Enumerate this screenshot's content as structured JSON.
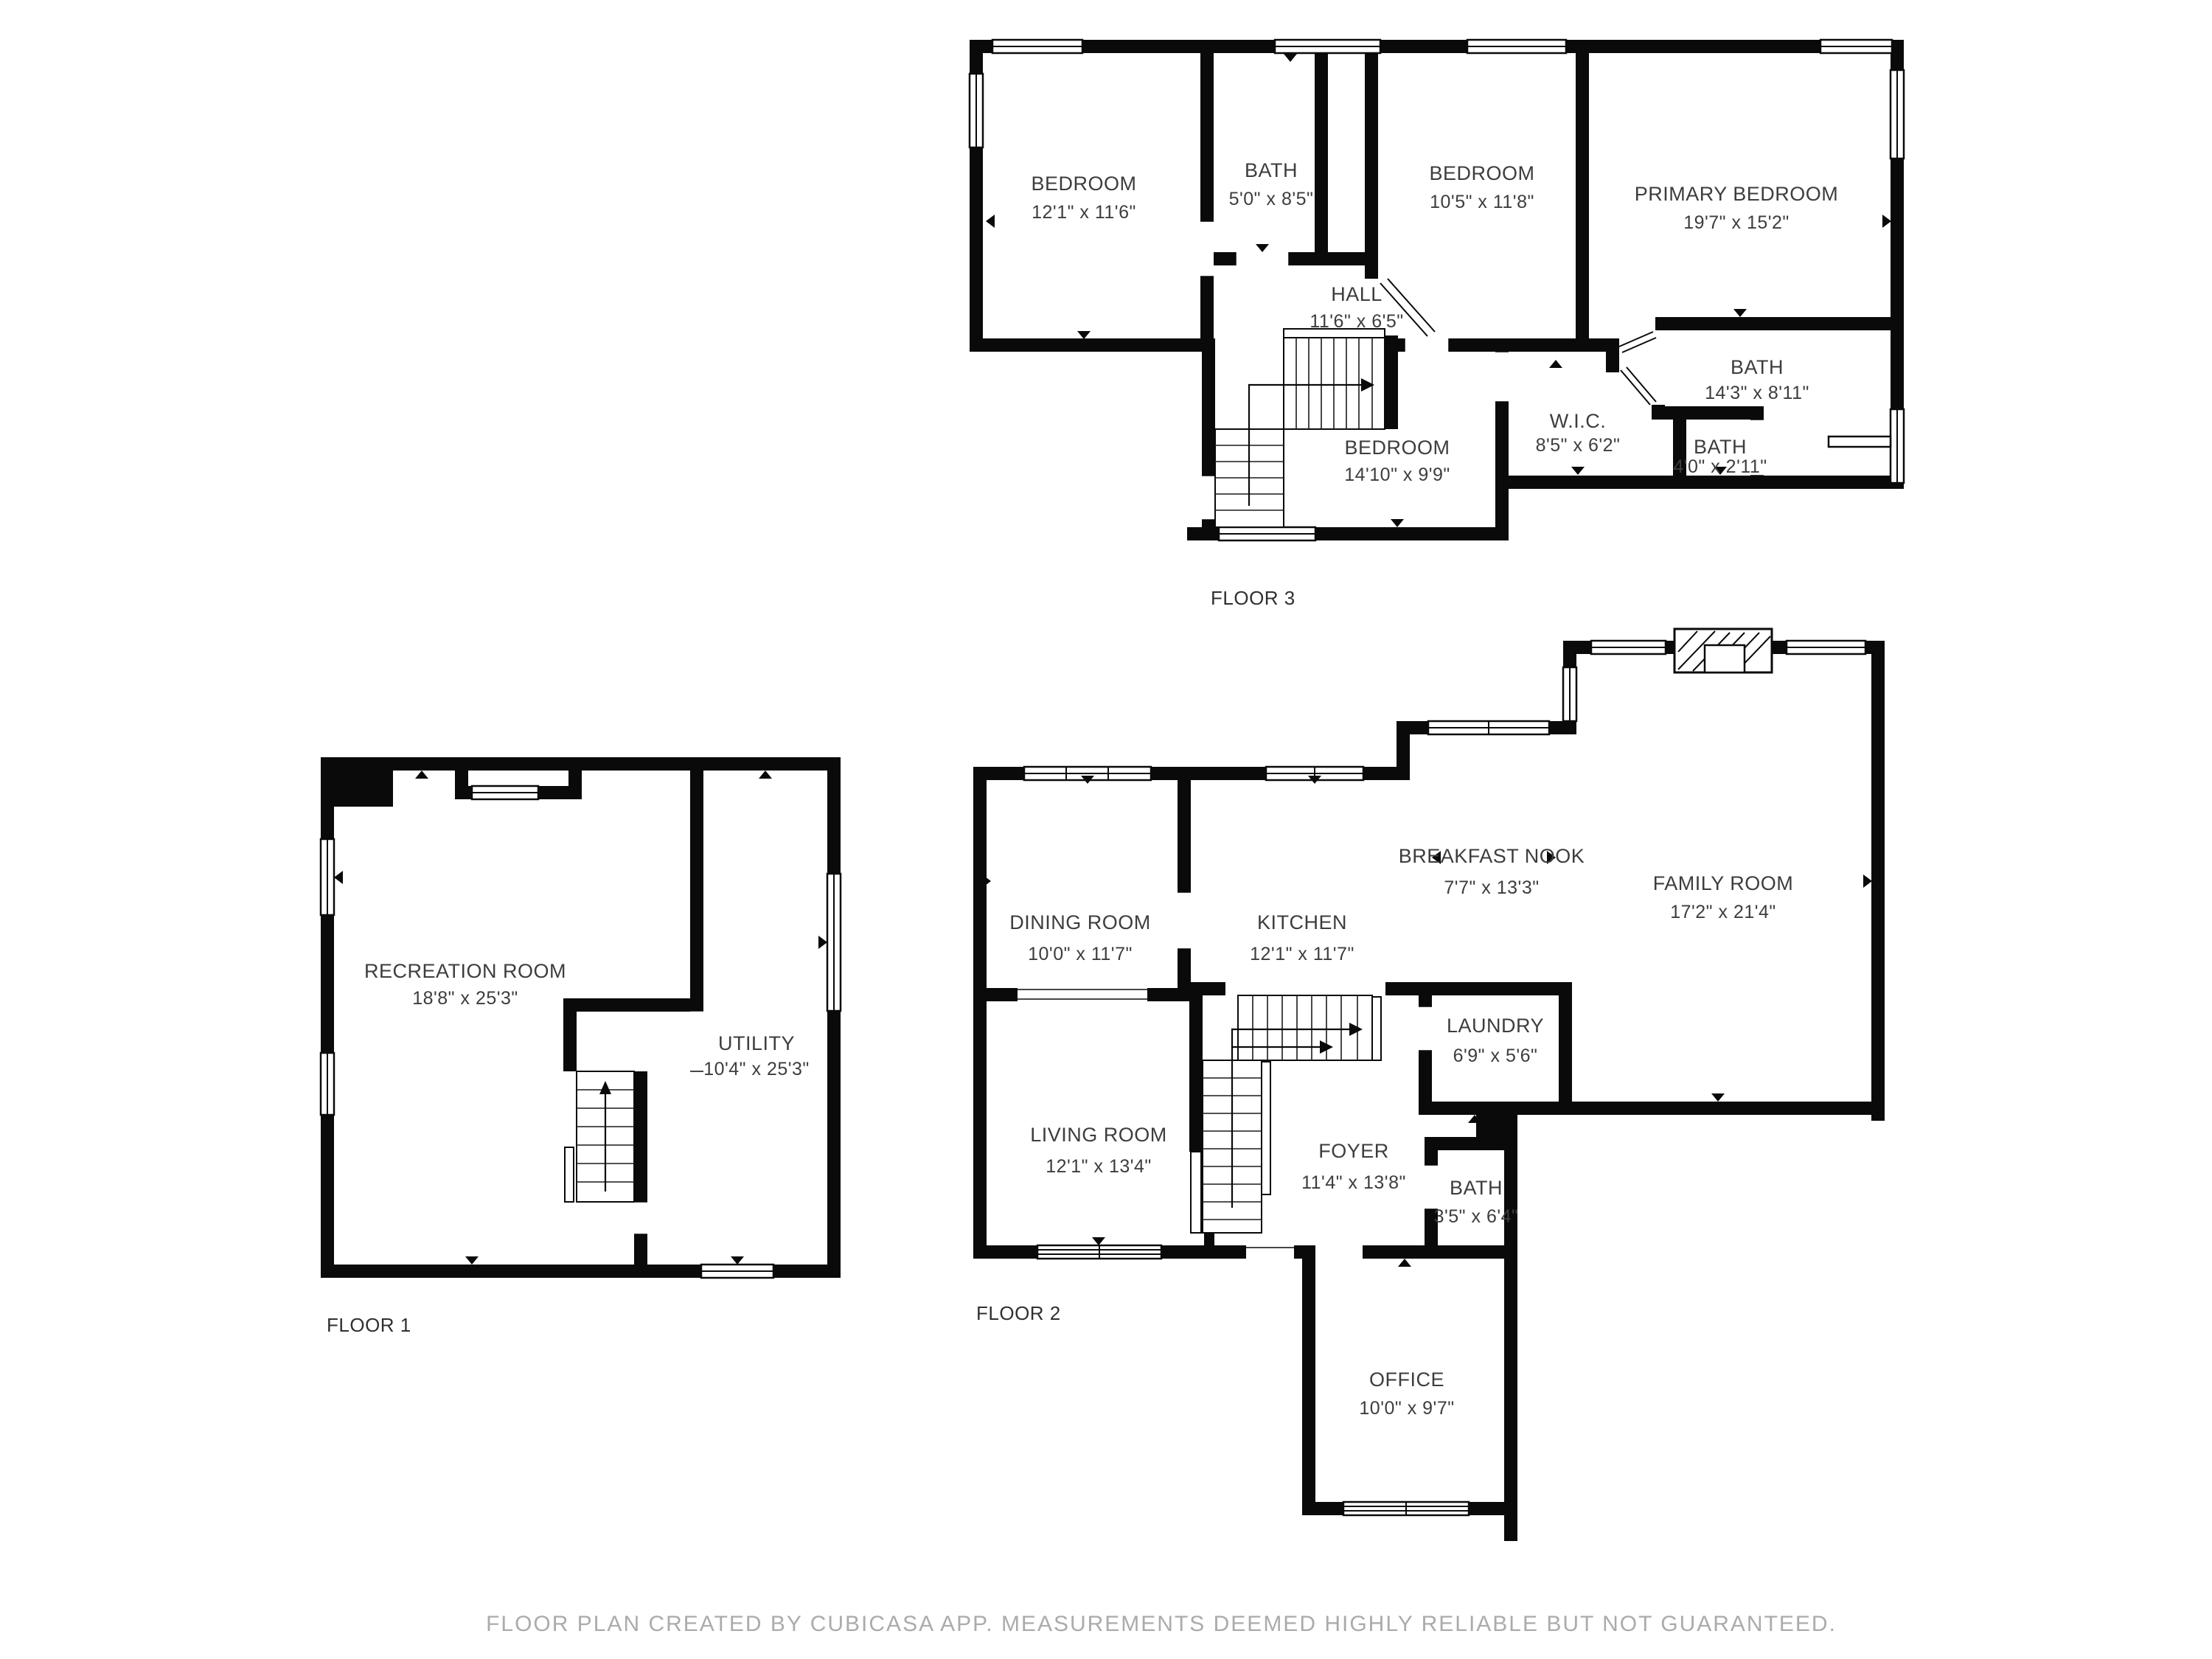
{
  "footer": {
    "disclaimer": "FLOOR PLAN CREATED BY CUBICASA APP. MEASUREMENTS DEEMED HIGHLY RELIABLE BUT NOT GUARANTEED."
  },
  "floors": {
    "floor3": {
      "label": "FLOOR 3",
      "rooms": {
        "bedroom_a": {
          "name": "BEDROOM",
          "dims": "12'1\" x 11'6\""
        },
        "bath_a": {
          "name": "BATH",
          "dims": "5'0\" x 8'5\""
        },
        "bedroom_b": {
          "name": "BEDROOM",
          "dims": "10'5\" x 11'8\""
        },
        "primary_bedroom": {
          "name": "PRIMARY BEDROOM",
          "dims": "19'7\" x 15'2\""
        },
        "hall": {
          "name": "HALL",
          "dims": "11'6\" x 6'5\""
        },
        "bath_b": {
          "name": "BATH",
          "dims": "14'3\" x 8'11\""
        },
        "wic": {
          "name": "W.I.C.",
          "dims": "8'5\" x 6'2\""
        },
        "bath_c": {
          "name": "BATH",
          "dims": "4'0\" x 2'11\""
        },
        "bedroom_c": {
          "name": "BEDROOM",
          "dims": "14'10\" x 9'9\""
        }
      }
    },
    "floor1": {
      "label": "FLOOR 1",
      "rooms": {
        "recreation": {
          "name": "RECREATION ROOM",
          "dims": "18'8\" x 25'3\""
        },
        "utility": {
          "name": "UTILITY",
          "dims": "10'4\" x 25'3\""
        }
      }
    },
    "floor2": {
      "label": "FLOOR 2",
      "rooms": {
        "dining": {
          "name": "DINING ROOM",
          "dims": "10'0\" x 11'7\""
        },
        "kitchen": {
          "name": "KITCHEN",
          "dims": "12'1\" x 11'7\""
        },
        "breakfast": {
          "name": "BREAKFAST NOOK",
          "dims": "7'7\" x 13'3\""
        },
        "family": {
          "name": "FAMILY ROOM",
          "dims": "17'2\" x 21'4\""
        },
        "laundry": {
          "name": "LAUNDRY",
          "dims": "6'9\" x 5'6\""
        },
        "living": {
          "name": "LIVING ROOM",
          "dims": "12'1\" x 13'4\""
        },
        "foyer": {
          "name": "FOYER",
          "dims": "11'4\" x 13'8\""
        },
        "bath": {
          "name": "BATH",
          "dims": "3'5\" x 6'4\""
        },
        "office": {
          "name": "OFFICE",
          "dims": "10'0\" x 9'7\""
        }
      }
    }
  }
}
